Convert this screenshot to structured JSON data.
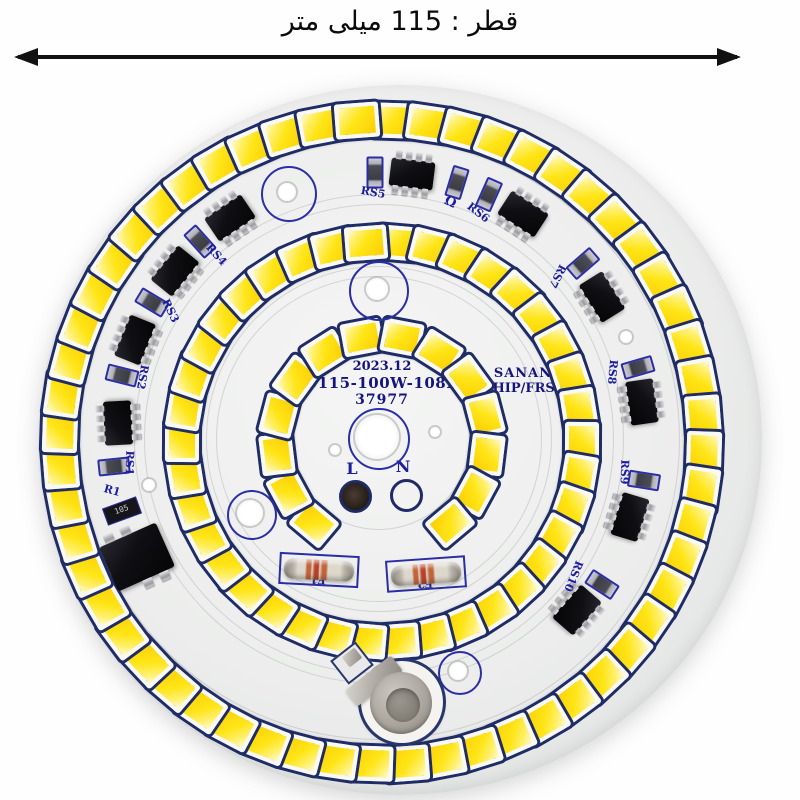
{
  "title": {
    "text": "قطر : 115 میلی متر",
    "dir": "rtl"
  },
  "board": {
    "ring_center": {
      "x": 378,
      "y": 438
    },
    "silkscreen_color": "#1c1c9e",
    "led_color": "#ffe516",
    "texts": {
      "date": "2023.12",
      "model": "D115-100W-108D",
      "serial": "37977",
      "brand_line1": "SANAN",
      "brand_line2": "CHIP/FRSS"
    },
    "led_rings": [
      {
        "name": "outer",
        "r": 322,
        "count": 56,
        "start": 2,
        "step": 6.4286,
        "w": 36,
        "h": 27
      },
      {
        "name": "middle",
        "r": 200,
        "count": 38,
        "start": 5,
        "step": 9.4737,
        "w": 34,
        "h": 26
      },
      {
        "name": "inner",
        "r": 106,
        "count": 14,
        "start": -140,
        "step": 21.54,
        "w": 32,
        "h": 25
      }
    ],
    "ics": [
      {
        "label": "RS5",
        "x": 412,
        "y": 174,
        "rot": 7
      },
      {
        "label": "RS6",
        "x": 523,
        "y": 214,
        "rot": 33
      },
      {
        "label": "RS7",
        "x": 602,
        "y": 297,
        "rot": 58
      },
      {
        "label": "RS8",
        "x": 642,
        "y": 402,
        "rot": 82
      },
      {
        "label": "RS9",
        "x": 630,
        "y": 517,
        "rot": 107
      },
      {
        "label": "RS10",
        "x": 577,
        "y": 610,
        "rot": 131
      },
      {
        "label": "RS1",
        "x": 118,
        "y": 423,
        "rot": 267
      },
      {
        "label": "RS2",
        "x": 135,
        "y": 340,
        "rot": 292
      },
      {
        "label": "RS3",
        "x": 175,
        "y": 271,
        "rot": 309
      },
      {
        "label": "RS4",
        "x": 230,
        "y": 218,
        "rot": 326
      }
    ],
    "resistors": [
      {
        "x": 373,
        "y": 170,
        "rot": 90
      },
      {
        "x": 455,
        "y": 180,
        "rot": 107
      },
      {
        "x": 487,
        "y": 192,
        "rot": 114
      },
      {
        "x": 581,
        "y": 261,
        "rot": 139
      },
      {
        "x": 636,
        "y": 365,
        "rot": 164
      },
      {
        "x": 642,
        "y": 478,
        "rot": 189
      },
      {
        "x": 600,
        "y": 582,
        "rot": 213
      },
      {
        "x": 112,
        "y": 464,
        "rot": 354
      },
      {
        "x": 120,
        "y": 373,
        "rot": 14
      },
      {
        "x": 150,
        "y": 300,
        "rot": 31
      },
      {
        "x": 198,
        "y": 239,
        "rot": 48
      }
    ],
    "r1_chip": {
      "x": 121,
      "y": 510,
      "rot": -20,
      "marking": "105"
    },
    "labels": [
      {
        "t": "RS5",
        "x": 373,
        "y": 193,
        "rot": 10,
        "size": 11
      },
      {
        "t": "Ω",
        "x": 450,
        "y": 203,
        "rot": 25,
        "size": 13
      },
      {
        "t": "RS6",
        "x": 478,
        "y": 213,
        "rot": 38,
        "size": 11
      },
      {
        "t": "RS7",
        "x": 557,
        "y": 276,
        "rot": 118,
        "size": 11
      },
      {
        "t": "RS8",
        "x": 612,
        "y": 372,
        "rot": 95,
        "size": 11
      },
      {
        "t": "RS9",
        "x": 624,
        "y": 472,
        "rot": 92,
        "size": 11
      },
      {
        "t": "RS10",
        "x": 573,
        "y": 576,
        "rot": 112,
        "size": 11
      },
      {
        "t": "RS1",
        "x": 129,
        "y": 463,
        "rot": 92,
        "size": 11
      },
      {
        "t": "RS2",
        "x": 142,
        "y": 377,
        "rot": 100,
        "size": 11
      },
      {
        "t": "RS3",
        "x": 170,
        "y": 311,
        "rot": 64,
        "size": 11
      },
      {
        "t": "RS4",
        "x": 216,
        "y": 255,
        "rot": 48,
        "size": 11
      },
      {
        "t": "R1",
        "x": 112,
        "y": 491,
        "rot": 15,
        "size": 11
      },
      {
        "t": "F1",
        "x": 318,
        "y": 579,
        "rot": 183,
        "size": 11
      },
      {
        "t": "F2",
        "x": 425,
        "y": 583,
        "rot": 177,
        "size": 11
      },
      {
        "t": "L",
        "x": 352,
        "y": 469,
        "rot": 0,
        "size": 16
      },
      {
        "t": "N",
        "x": 403,
        "y": 467,
        "rot": 0,
        "size": 16
      }
    ],
    "fuses": [
      {
        "name": "F1",
        "x": 317,
        "y": 568,
        "rot": 3
      },
      {
        "name": "F2",
        "x": 424,
        "y": 572,
        "rot": -4
      }
    ],
    "pads": [
      {
        "name": "L",
        "x": 352,
        "y": 493,
        "filled": true
      },
      {
        "name": "N",
        "x": 403,
        "y": 492,
        "filled": false
      }
    ],
    "holes": [
      {
        "x": 377,
        "y": 437,
        "ring": 29,
        "hole": 22
      },
      {
        "x": 287,
        "y": 192,
        "ring": 26,
        "hole": 9
      },
      {
        "x": 377,
        "y": 289,
        "ring": 28,
        "hole": 11
      },
      {
        "x": 250,
        "y": 513,
        "ring": 23,
        "hole": 13
      },
      {
        "x": 458,
        "y": 671,
        "ring": 20,
        "hole": 9
      },
      {
        "x": 626,
        "y": 337,
        "ring": 0,
        "hole": 6
      },
      {
        "x": 149,
        "y": 485,
        "ring": 0,
        "hole": 6
      },
      {
        "x": 335,
        "y": 450,
        "ring": 0,
        "hole": 5
      },
      {
        "x": 435,
        "y": 432,
        "ring": 0,
        "hole": 5
      }
    ],
    "trace_radii": [
      300,
      244,
      234,
      172,
      162,
      90
    ],
    "bridge": {
      "x": 137,
      "y": 557,
      "rot": -24
    },
    "metal_post": {
      "ring_x": 402,
      "ring_y": 702,
      "disc_x": 401,
      "disc_y": 703
    }
  }
}
